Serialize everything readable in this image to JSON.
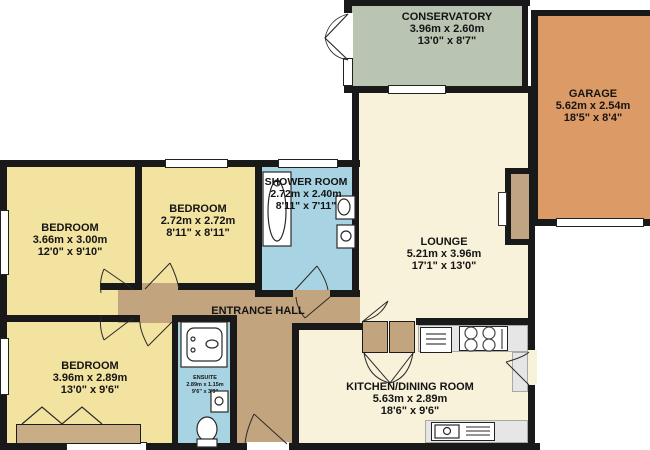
{
  "plan_title": "Bungalow floor plan",
  "rooms": {
    "conservatory": {
      "name": "CONSERVATORY",
      "metric": "3.96m  x 2.60m",
      "imperial": "13'0\"  x 8'7\""
    },
    "garage": {
      "name": "GARAGE",
      "metric": "5.62m  x 2.54m",
      "imperial": "18'5\"  x 8'4\""
    },
    "lounge": {
      "name": "LOUNGE",
      "metric": "5.21m  x 3.96m",
      "imperial": "17'1\"  x 13'0\""
    },
    "shower_room": {
      "name": "SHOWER ROOM",
      "metric": "2.72m  x 2.40m",
      "imperial": "8'11\"  x 7'11\""
    },
    "bedroom_left": {
      "name": "BEDROOM",
      "metric": "3.66m  x 3.00m",
      "imperial": "12'0\"  x 9'10\""
    },
    "bedroom_mid": {
      "name": "BEDROOM",
      "metric": "2.72m  x 2.72m",
      "imperial": "8'11\"  x 8'11\""
    },
    "bedroom_bottom": {
      "name": "BEDROOM",
      "metric": "3.96m  x 2.89m",
      "imperial": "13'0\"  x 9'6\""
    },
    "kitchen": {
      "name": "KITCHEN/DINING ROOM",
      "metric": "5.63m  x 2.89m",
      "imperial": "18'6\"  x 9'6\""
    },
    "entrance_hall": {
      "name": "ENTRANCE HALL"
    },
    "ensuite": {
      "name": "ENSUITE",
      "metric": "2.89m  x 1.15m",
      "imperial": "9'6\"  x 3'9\""
    }
  },
  "palette": {
    "wall": "#191919",
    "bedroom": "#f3e3a1",
    "bathroom": "#a8d3e3",
    "hall": "#c2a57e",
    "living": "#f8f2db",
    "conservatory": "#b9c4b2",
    "garage": "#dc9b66",
    "counter": "#e6e6e6",
    "text": "#141414"
  }
}
